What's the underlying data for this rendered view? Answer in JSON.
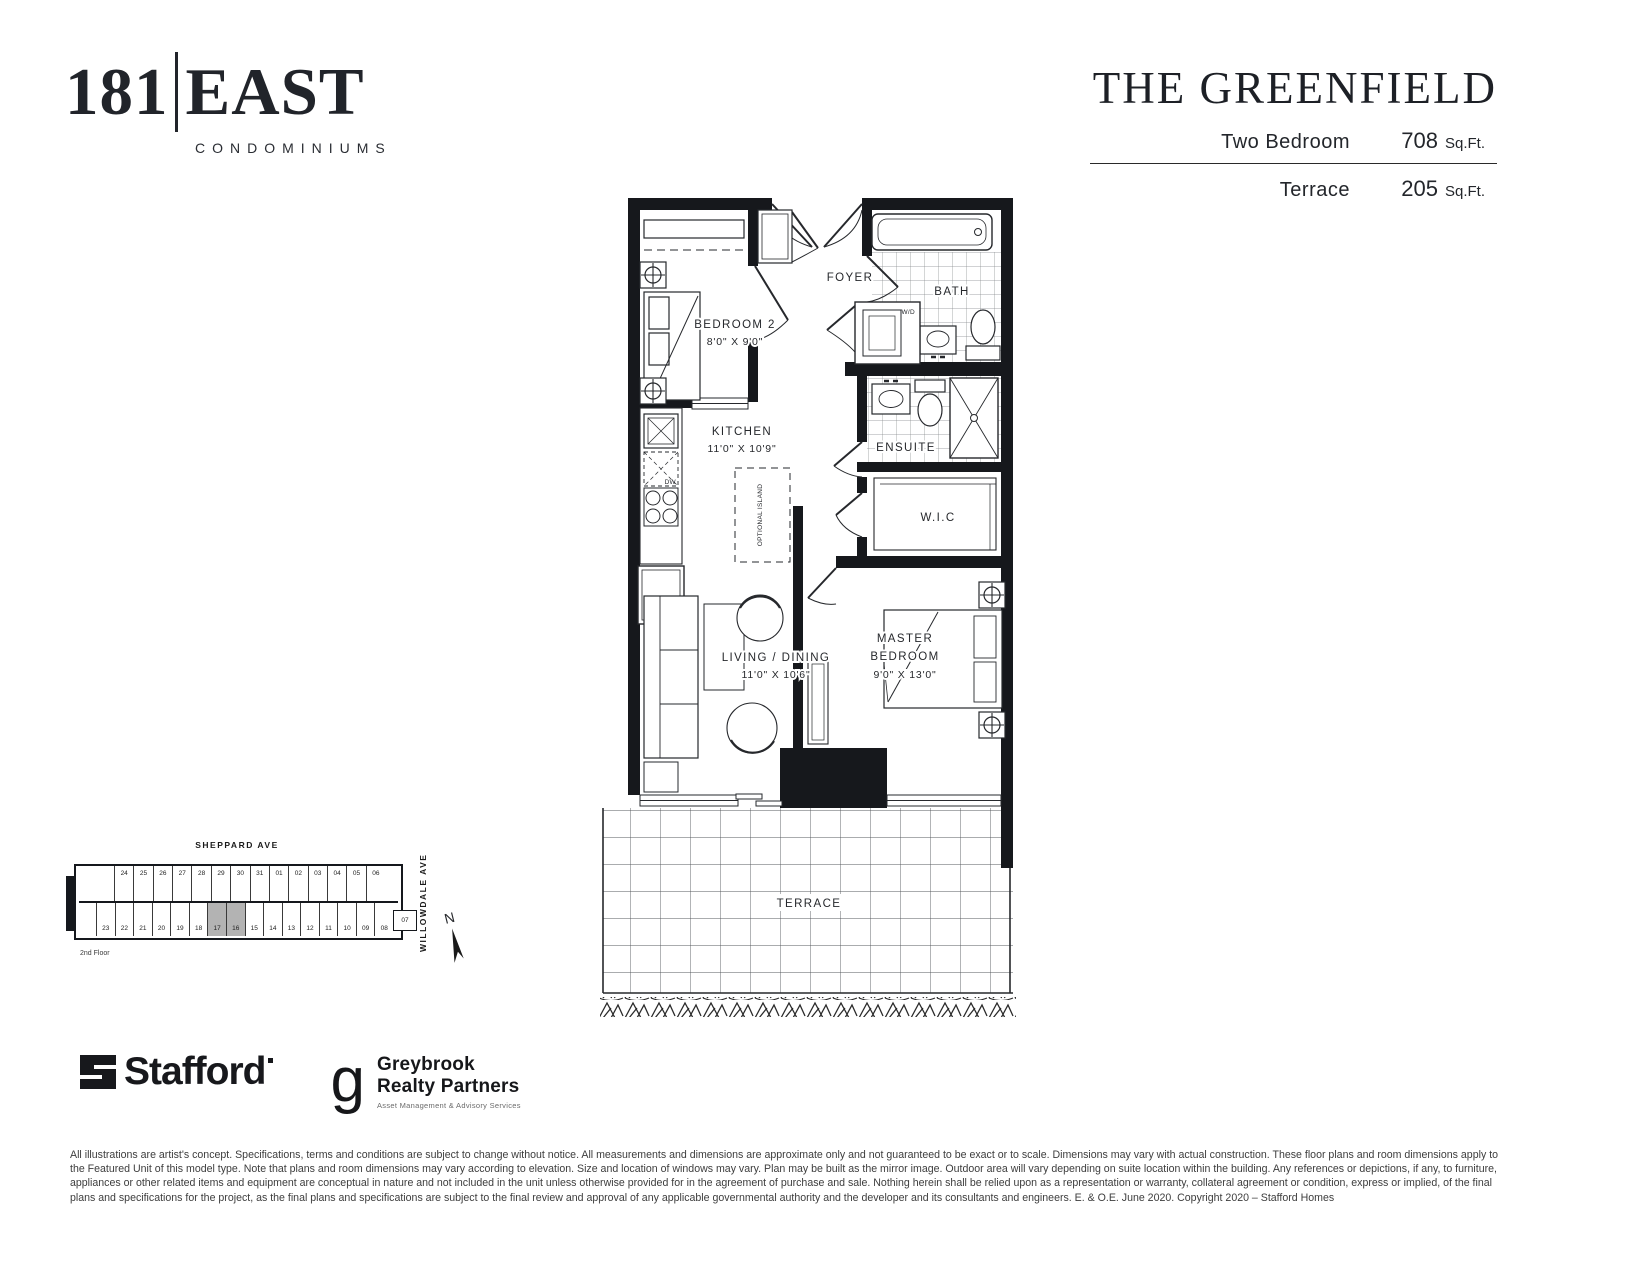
{
  "logo": {
    "number": "181",
    "name": "EAST",
    "tagline": "CONDOMINIUMS"
  },
  "header": {
    "plan_name": "THE GREENFIELD",
    "rows": [
      {
        "label": "Two Bedroom",
        "value": "708",
        "unit": "Sq.Ft."
      },
      {
        "label": "Terrace",
        "value": "205",
        "unit": "Sq.Ft."
      }
    ]
  },
  "floorplan": {
    "rooms": {
      "bedroom2": {
        "name": "BEDROOM 2",
        "dims": "8'0\" X 9'0\""
      },
      "foyer": {
        "name": "FOYER"
      },
      "bath": {
        "name": "BATH"
      },
      "wd": {
        "name": "W/D"
      },
      "ensuite": {
        "name": "ENSUITE"
      },
      "kitchen": {
        "name": "KITCHEN",
        "dims": "11'0\" X 10'9\""
      },
      "island": {
        "name": "OPTIONAL ISLAND"
      },
      "wic": {
        "name": "W.I.C"
      },
      "living": {
        "name": "LIVING / DINING",
        "dims": "11'0\" X 10'6\""
      },
      "master": {
        "name1": "MASTER",
        "name2": "BEDROOM",
        "dims": "9'0\" X 13'0\""
      },
      "terrace": {
        "name": "TERRACE"
      },
      "dw": "DW",
      "fridge": "F"
    }
  },
  "keyplan": {
    "street_top": "SHEPPARD AVE",
    "street_right": "WILLOWDALE AVE",
    "floor_label": "2nd Floor",
    "north_label": "N",
    "top_row": [
      "24",
      "25",
      "26",
      "27",
      "28",
      "29",
      "30",
      "31",
      "01",
      "02",
      "03",
      "04",
      "05",
      "06"
    ],
    "side_unit": "07",
    "bottom_row": [
      "23",
      "22",
      "21",
      "20",
      "19",
      "18",
      "17",
      "16",
      "15",
      "14",
      "13",
      "12",
      "11",
      "10",
      "09",
      "08"
    ],
    "highlighted_units": [
      "17",
      "16"
    ]
  },
  "footer": {
    "stafford": "Stafford",
    "greybrook_g": "g",
    "greybrook_line1": "Greybrook",
    "greybrook_line2": "Realty Partners",
    "greybrook_sub": "Asset Management & Advisory Services",
    "disclaimer": "All illustrations are artist's concept. Specifications, terms and conditions are subject to change without notice. All measurements and dimensions are approximate only and not guaranteed to be exact or to scale. Dimensions may vary with actual construction. These floor plans and room dimensions apply to the Featured Unit of this model type. Note that plans and room dimensions may vary according to elevation. Size and location of windows may vary. Plan may be built as the mirror image. Outdoor area will vary depending on suite location within the building. Any references or depictions, if any, to furniture, appliances or other related items and equipment are conceptual in nature and not included in the unit unless otherwise provided for in the agreement of purchase and sale. Nothing herein shall be relied upon as a representation or warranty, collateral agreement or condition, express or implied, of the final plans and specifications for the project, as the final plans and specifications are subject to the final review and approval of any applicable governmental authority and the developer and its consultants and engineers. E. & O.E. June 2020. Copyright 2020 – Stafford Homes"
  }
}
